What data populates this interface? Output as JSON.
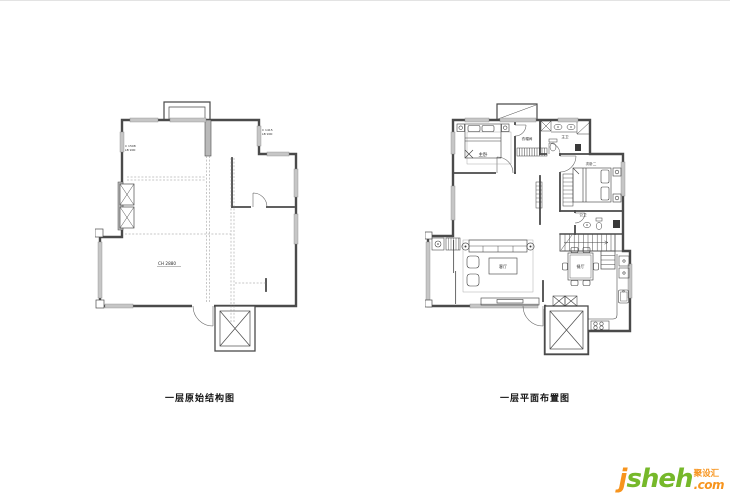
{
  "plans": {
    "left": {
      "title": "一层原始结构图",
      "annotations": {
        "ceiling_height": "CH 2880",
        "window_code_left_1": "C 1508",
        "window_code_left_2": "LB 900",
        "window_code_right_1": "C 1415",
        "window_code_right_2": "LB 900"
      }
    },
    "right": {
      "title": "一层平面布置图",
      "rooms": {
        "master_bedroom": "主卧",
        "cloakroom": "衣帽间",
        "master_bath": "主卫",
        "bedroom_two": "次卧二",
        "public_bath": "公卫",
        "living_room": "客厅",
        "dining_room": "餐厅"
      }
    }
  },
  "watermark": {
    "brand_initial": "j",
    "brand_rest": "sheh",
    "tld": ".com",
    "cn": "聚设汇"
  },
  "colors": {
    "wall": "#4a4a4a",
    "window_fill": "#c6c6c6",
    "brand_orange": "#f7941d",
    "brand_green": "#76b82a"
  }
}
